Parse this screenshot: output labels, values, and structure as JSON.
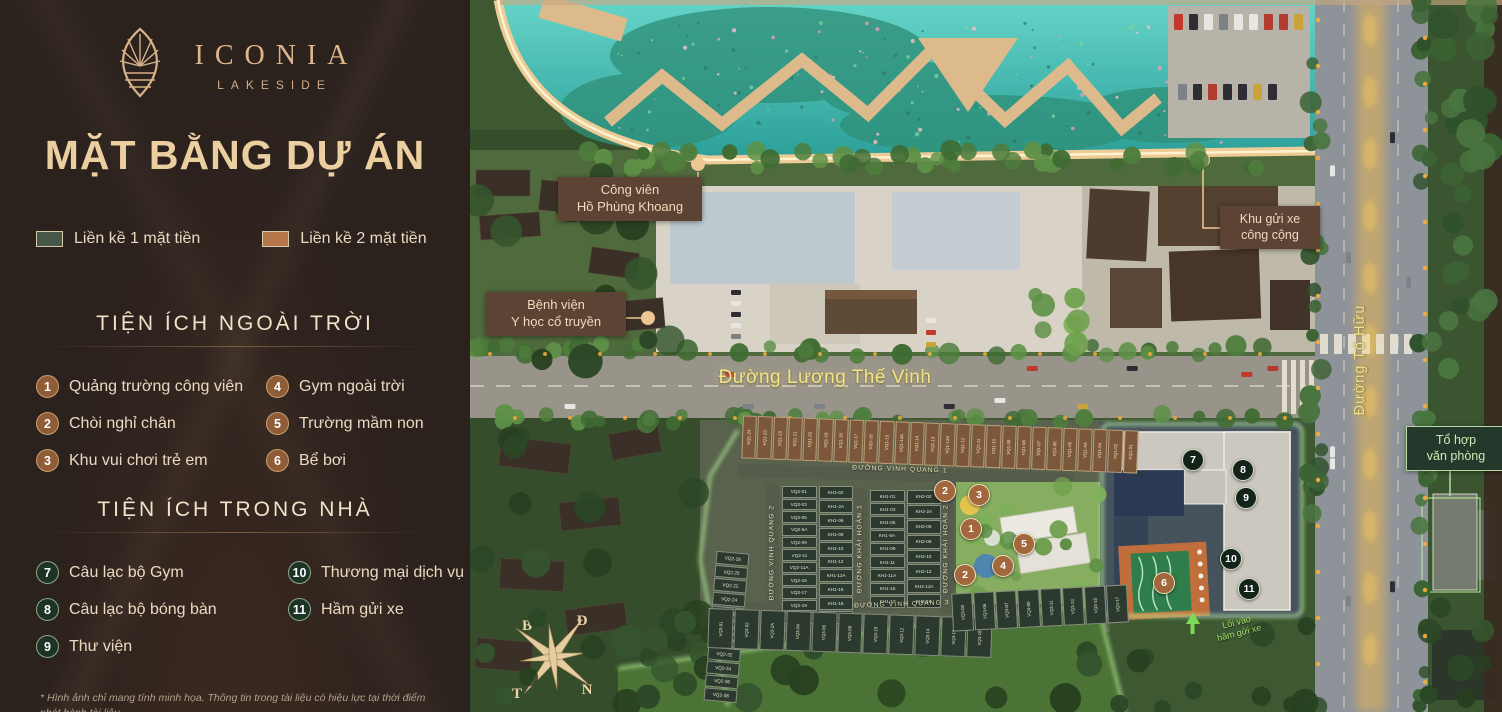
{
  "panel": {
    "brand": {
      "name": "ICONIA",
      "sub": "LAKESIDE",
      "logo_icon": "lotus-leaf-icon"
    },
    "title": "MẶT BẰNG DỰ ÁN",
    "legend": [
      {
        "label": "Liền kề 1 mặt tiền",
        "color": "#47584a"
      },
      {
        "label": "Liền kề 2 mặt tiền",
        "color": "#b5764a"
      }
    ],
    "outdoor": {
      "heading": "TIỆN ÍCH NGOÀI TRỜI",
      "items": [
        {
          "num": "1",
          "label": "Quảng trường công viên"
        },
        {
          "num": "2",
          "label": "Chòi nghỉ chân"
        },
        {
          "num": "3",
          "label": "Khu vui chơi trẻ em"
        },
        {
          "num": "4",
          "label": "Gym ngoài trời"
        },
        {
          "num": "5",
          "label": "Trường mầm non"
        },
        {
          "num": "6",
          "label": "Bể bơi"
        }
      ]
    },
    "indoor": {
      "heading": "TIỆN ÍCH TRONG NHÀ",
      "items": [
        {
          "num": "7",
          "label": "Câu lạc bộ Gym"
        },
        {
          "num": "8",
          "label": "Câu lạc bộ bóng bàn"
        },
        {
          "num": "9",
          "label": "Thư viện"
        },
        {
          "num": "10",
          "label": "Thương mại dịch vụ"
        },
        {
          "num": "11",
          "label": "Hầm gửi xe"
        }
      ]
    },
    "disclaimer": "* Hình ảnh chỉ mang tính minh họa. Thông tin trong tài liệu có hiệu lực tại thời điểm",
    "disclaimer2": "phát hành tài liệu."
  },
  "map": {
    "callouts": {
      "park": {
        "line1": "Công viên",
        "line2": "Hồ Phùng Khoang"
      },
      "hospital": {
        "line1": "Bệnh viện",
        "line2": "Y học cổ truyền"
      },
      "parking": {
        "line1": "Khu gửi xe",
        "line2": "công cộng"
      },
      "office": {
        "line1": "Tổ hợp",
        "line2": "văn phòng"
      }
    },
    "roads": {
      "main": "Đường Lương Thế Vinh",
      "right": "Đường Tố Hữu",
      "internal": [
        "ĐƯỜNG VINH QUANG 1",
        "ĐƯỜNG VINH QUANG 2",
        "ĐƯỜNG KHẢI HOÀN 1",
        "ĐƯỜNG KHẢI HOÀN 2",
        "ĐƯỜNG VINH QUANG 3"
      ]
    },
    "basement": {
      "line1": "Lối vào",
      "line2": "hầm gửi xe"
    },
    "compass": {
      "top_left": "B",
      "top_right": "Đ",
      "bottom_left": "T",
      "bottom_right": "N"
    },
    "amenity_markers": [
      {
        "num": "1",
        "type": "outdoor",
        "x": 500,
        "y": 528
      },
      {
        "num": "2",
        "type": "outdoor",
        "x": 474,
        "y": 490
      },
      {
        "num": "2",
        "type": "outdoor",
        "x": 494,
        "y": 574
      },
      {
        "num": "3",
        "type": "outdoor",
        "x": 508,
        "y": 494
      },
      {
        "num": "4",
        "type": "outdoor",
        "x": 532,
        "y": 565
      },
      {
        "num": "5",
        "type": "outdoor",
        "x": 553,
        "y": 543
      },
      {
        "num": "6",
        "type": "outdoor",
        "x": 693,
        "y": 582
      },
      {
        "num": "7",
        "type": "indoor",
        "x": 722,
        "y": 459
      },
      {
        "num": "8",
        "type": "indoor",
        "x": 772,
        "y": 469
      },
      {
        "num": "9",
        "type": "indoor",
        "x": 775,
        "y": 497
      },
      {
        "num": "10",
        "type": "indoor",
        "x": 760,
        "y": 558
      },
      {
        "num": "11",
        "type": "indoor",
        "x": 778,
        "y": 588
      }
    ],
    "plots": {
      "vq1_row": [
        "VQ1-24",
        "VQ1-23",
        "VQ1-22",
        "VQ1-21",
        "VQ1-20",
        "VQ1-19",
        "VQ1-18",
        "VQ1-17",
        "VQ1-16",
        "VQ1-15",
        "VQ1-14A",
        "VQ1-14",
        "VQ1-13",
        "VQ1-12A",
        "VQ1-12",
        "VQ1-11",
        "VQ1-10",
        "VQ1-09",
        "VQ1-08",
        "VQ1-07",
        "VQ1-06",
        "VQ1-05",
        "VQ1-4A",
        "VQ1-04",
        "VQ1-02",
        "VQ1-01"
      ],
      "block_left_col1": [
        "VQ2-01",
        "VQ2-03",
        "VQ2-05",
        "VQ2-5A",
        "VQ2-09",
        "VQ2-11",
        "VQ2-11A",
        "VQ2-15",
        "VQ2-17",
        "VQ2-19",
        "VQ2-21"
      ],
      "block_left_col2": [
        "KH1-02",
        "KH1-2A",
        "KH1-06",
        "KH1-08",
        "KH1-10",
        "KH1-12",
        "KH1-12A",
        "KH1-16",
        "KH1-18",
        "KH1-20"
      ],
      "block_mid_col1": [
        "KH1-01",
        "KH1-03",
        "KH1-05",
        "KH1-5A",
        "KH1-09",
        "KH1-11",
        "KH1-11A",
        "KH1-15",
        "KH1-17"
      ],
      "block_mid_col2": [
        "KH2-02",
        "KH2-2A",
        "KH2-06",
        "KH2-08",
        "KH2-10",
        "KH2-12",
        "KH2-12A",
        "KH2-16"
      ],
      "col_vq2_lower": [
        "VQ2-18",
        "VQ2-20",
        "VQ2-22",
        "VQ2-24",
        "VQ2-26",
        "VQ2-28",
        "VQ2-30",
        "VQ2-32",
        "VQ2-34",
        "VQ2-36",
        "VQ2-38"
      ],
      "vq3_row_left": [
        "VQ3-01",
        "VQ3-02",
        "VQ3-2A",
        "VQ3-04",
        "VQ3-06",
        "VQ3-08",
        "VQ3-10",
        "VQ3-12",
        "VQ3-14",
        "VQ3-16",
        "VQ3-18"
      ],
      "vq3_row_right": [
        "VQ3-03",
        "VQ3-05",
        "VQ3-07",
        "VQ3-09",
        "VQ3-11",
        "VQ3-13",
        "VQ3-15",
        "VQ3-17"
      ]
    },
    "colors": {
      "site_glow": "#bdf79e",
      "marker_outdoor": "#a2673c",
      "marker_indoor": "#14231a",
      "road_label": "#f3e488"
    }
  }
}
